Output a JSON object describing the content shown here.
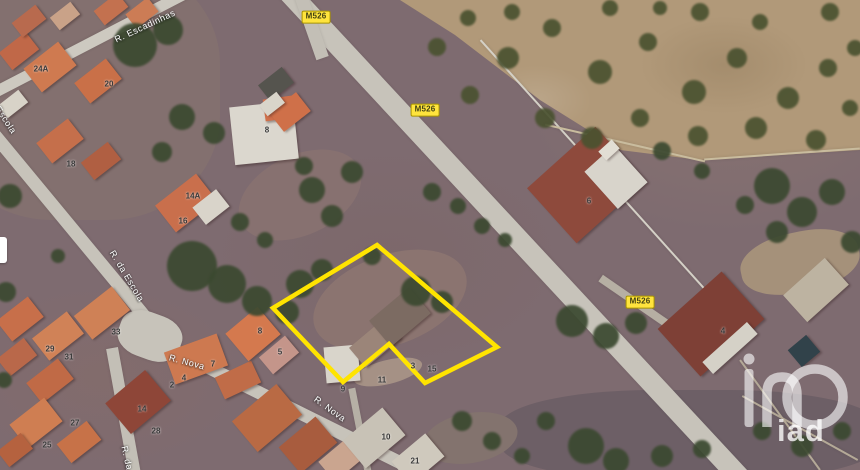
{
  "map": {
    "kind": "satellite-aerial-view",
    "watermark": {
      "text": "iad"
    },
    "parcel": {
      "outline_color": "#ffe400",
      "points": [
        [
          377,
          245
        ],
        [
          497,
          347
        ],
        [
          425,
          383
        ],
        [
          389,
          344
        ],
        [
          343,
          382
        ],
        [
          273,
          308
        ]
      ]
    },
    "road_badges": [
      {
        "label": "M526",
        "x": 316,
        "y": 17
      },
      {
        "label": "M526",
        "x": 425,
        "y": 110
      },
      {
        "label": "M526",
        "x": 640,
        "y": 302
      }
    ],
    "street_labels": [
      {
        "text": "R. Escadinhas",
        "x": 145,
        "y": 26,
        "angle": -25
      },
      {
        "text": "Escola",
        "x": 6,
        "y": 120,
        "angle": 57
      },
      {
        "text": "R. da Escola",
        "x": 127,
        "y": 276,
        "angle": 59
      },
      {
        "text": "R. Nova",
        "x": 187,
        "y": 362,
        "angle": 15
      },
      {
        "text": "R. Nova",
        "x": 330,
        "y": 409,
        "angle": 36
      },
      {
        "text": "R. da",
        "x": 127,
        "y": 458,
        "angle": 77
      }
    ],
    "house_numbers": [
      {
        "text": "24A",
        "x": 41,
        "y": 69
      },
      {
        "text": "20",
        "x": 109,
        "y": 84
      },
      {
        "text": "18",
        "x": 71,
        "y": 164
      },
      {
        "text": "8",
        "x": 267,
        "y": 130
      },
      {
        "text": "14A",
        "x": 193,
        "y": 196
      },
      {
        "text": "16",
        "x": 183,
        "y": 221
      },
      {
        "text": "6",
        "x": 589,
        "y": 201
      },
      {
        "text": "4",
        "x": 723,
        "y": 331
      },
      {
        "text": "33",
        "x": 116,
        "y": 332
      },
      {
        "text": "29",
        "x": 50,
        "y": 349
      },
      {
        "text": "31",
        "x": 69,
        "y": 357
      },
      {
        "text": "27",
        "x": 75,
        "y": 423
      },
      {
        "text": "25",
        "x": 47,
        "y": 445
      },
      {
        "text": "14",
        "x": 142,
        "y": 409
      },
      {
        "text": "28",
        "x": 156,
        "y": 431
      },
      {
        "text": "8",
        "x": 260,
        "y": 331
      },
      {
        "text": "5",
        "x": 280,
        "y": 352
      },
      {
        "text": "7",
        "x": 213,
        "y": 364
      },
      {
        "text": "4",
        "x": 184,
        "y": 378
      },
      {
        "text": "2",
        "x": 172,
        "y": 385
      },
      {
        "text": "3",
        "x": 413,
        "y": 366
      },
      {
        "text": "15",
        "x": 432,
        "y": 369
      },
      {
        "text": "11",
        "x": 382,
        "y": 380
      },
      {
        "text": "9",
        "x": 343,
        "y": 389
      },
      {
        "text": "10",
        "x": 386,
        "y": 437
      },
      {
        "text": "21",
        "x": 415,
        "y": 461
      }
    ],
    "features": {
      "roads": [
        [
          512,
          232,
          676,
          21,
          47.1,
          "#c7c3ba"
        ],
        [
          311,
          26,
          67,
          13,
          70.7,
          "#c3bfb6"
        ],
        [
          95,
          40,
          226,
          11,
          -27.4,
          "#cdc9c0"
        ],
        [
          69,
          225,
          241,
          13,
          50.4,
          "#c7c3ba"
        ],
        [
          285,
          405,
          328,
          13,
          26.4,
          "#c7c3ba"
        ],
        [
          124,
          414,
          134,
          12,
          79.7,
          "#c3bfb6"
        ],
        [
          360,
          430,
          86,
          7,
          79,
          "#b6b0a5"
        ],
        [
          645,
          309,
          109,
          8,
          34.6,
          "#b6afa3"
        ],
        [
          150,
          336,
          64,
          46,
          20,
          "#c7c3ba",
          40
        ],
        [
          611,
          185,
          390,
          2,
          48,
          "#d4d0c6"
        ],
        [
          625,
          143,
          164,
          2,
          13,
          "#c9bc9e"
        ],
        [
          782,
          154,
          156,
          2,
          -4,
          "#c9bc9e"
        ],
        [
          800,
          428,
          132,
          2,
          29,
          "#b4a997"
        ],
        [
          780,
          415,
          136,
          2,
          54,
          "#b4a997"
        ]
      ],
      "fields": [
        [
          80,
          90,
          280,
          260,
          0,
          "#83706f",
          40
        ],
        [
          690,
          435,
          380,
          90,
          0,
          "#6d5f66",
          40
        ],
        [
          800,
          262,
          120,
          60,
          -12,
          "#a5917a",
          45
        ],
        [
          390,
          300,
          160,
          90,
          -20,
          "#8b7470",
          50
        ],
        [
          300,
          195,
          130,
          80,
          -25,
          "#877170",
          50
        ],
        [
          470,
          438,
          95,
          50,
          -10,
          "#83736e",
          50
        ],
        [
          388,
          372,
          70,
          24,
          -14,
          "#a59185",
          50
        ]
      ],
      "buildings": [
        [
          19,
          51,
          34,
          22,
          -38,
          "#c06848"
        ],
        [
          50,
          67,
          44,
          30,
          -38,
          "#cf7a50"
        ],
        [
          98,
          81,
          40,
          26,
          -38,
          "#c97048"
        ],
        [
          29,
          21,
          30,
          18,
          -38,
          "#b86a4e"
        ],
        [
          65,
          16,
          26,
          16,
          -38,
          "#c9a288"
        ],
        [
          111,
          9,
          30,
          18,
          -38,
          "#c3714f"
        ],
        [
          142,
          13,
          28,
          18,
          -38,
          "#cc7c55"
        ],
        [
          13,
          104,
          26,
          16,
          -38,
          "#d8d3c8"
        ],
        [
          60,
          141,
          40,
          26,
          -38,
          "#c56f4b"
        ],
        [
          101,
          161,
          34,
          22,
          -38,
          "#b05f42"
        ],
        [
          264,
          133,
          64,
          58,
          -6,
          "#dbd7ce"
        ],
        [
          282,
          108,
          36,
          22,
          -8,
          "#cf6f4a"
        ],
        [
          276,
          84,
          30,
          20,
          -38,
          "#55544e"
        ],
        [
          290,
          112,
          34,
          24,
          -38,
          "#cf7049"
        ],
        [
          272,
          104,
          22,
          14,
          -38,
          "#d9d5ca"
        ],
        [
          186,
          203,
          52,
          34,
          -38,
          "#c96f4c"
        ],
        [
          211,
          207,
          30,
          22,
          -38,
          "#d9d4ca"
        ],
        [
          20,
          319,
          40,
          26,
          -38,
          "#c76f4a"
        ],
        [
          58,
          336,
          44,
          28,
          -38,
          "#d08257"
        ],
        [
          102,
          313,
          48,
          30,
          -38,
          "#cf8156"
        ],
        [
          17,
          357,
          34,
          22,
          -38,
          "#b9684a"
        ],
        [
          50,
          381,
          40,
          26,
          -38,
          "#c06a46"
        ],
        [
          36,
          423,
          44,
          30,
          -38,
          "#cf7e52"
        ],
        [
          79,
          442,
          38,
          24,
          -38,
          "#c77248"
        ],
        [
          15,
          450,
          30,
          20,
          -38,
          "#b5623f"
        ],
        [
          138,
          402,
          52,
          40,
          -40,
          "#8e4638"
        ],
        [
          196,
          359,
          56,
          34,
          -20,
          "#cd7950"
        ],
        [
          238,
          380,
          40,
          24,
          -25,
          "#c06c48"
        ],
        [
          253,
          334,
          42,
          36,
          -40,
          "#d4794e"
        ],
        [
          279,
          355,
          34,
          22,
          -40,
          "#c4958a"
        ],
        [
          267,
          418,
          58,
          40,
          -40,
          "#b96a44"
        ],
        [
          308,
          445,
          48,
          34,
          -40,
          "#a85c3e"
        ],
        [
          342,
          459,
          40,
          26,
          -40,
          "#caa58f"
        ],
        [
          374,
          438,
          52,
          36,
          -40,
          "#c8c2b6"
        ],
        [
          418,
          459,
          44,
          30,
          -40,
          "#cfc9bd"
        ],
        [
          342,
          364,
          34,
          36,
          -5,
          "#d9d5cb"
        ],
        [
          375,
          343,
          46,
          26,
          -40,
          "#9b8579"
        ],
        [
          400,
          317,
          52,
          34,
          -40,
          "#7c6b62"
        ],
        [
          586,
          185,
          92,
          74,
          -42,
          "#8e4a3c"
        ],
        [
          616,
          177,
          40,
          50,
          -42,
          "#d8d4cb"
        ],
        [
          609,
          150,
          18,
          12,
          -42,
          "#e2ded4"
        ],
        [
          711,
          324,
          86,
          64,
          -42,
          "#7e4036"
        ],
        [
          730,
          348,
          60,
          16,
          -42,
          "#d5d1c7"
        ],
        [
          816,
          290,
          56,
          36,
          -42,
          "#bdb3a1"
        ],
        [
          804,
          351,
          24,
          22,
          -40,
          "#31424a"
        ]
      ],
      "trees_olive": [
        [
          437,
          47,
          9
        ],
        [
          468,
          18,
          8
        ],
        [
          508,
          58,
          11
        ],
        [
          552,
          28,
          9
        ],
        [
          600,
          72,
          12
        ],
        [
          648,
          42,
          9
        ],
        [
          694,
          92,
          12
        ],
        [
          737,
          58,
          10
        ],
        [
          788,
          98,
          11
        ],
        [
          828,
          68,
          9
        ],
        [
          545,
          118,
          10
        ],
        [
          592,
          138,
          11
        ],
        [
          640,
          118,
          9
        ],
        [
          698,
          136,
          10
        ],
        [
          756,
          128,
          11
        ],
        [
          816,
          140,
          10
        ],
        [
          850,
          108,
          8
        ],
        [
          470,
          95,
          9
        ],
        [
          512,
          12,
          8
        ],
        [
          700,
          12,
          9
        ],
        [
          760,
          22,
          8
        ],
        [
          830,
          12,
          9
        ],
        [
          855,
          48,
          8
        ],
        [
          610,
          8,
          8
        ],
        [
          660,
          8,
          7
        ]
      ],
      "trees_dark": [
        [
          135,
          45,
          22
        ],
        [
          168,
          30,
          15
        ],
        [
          182,
          117,
          13
        ],
        [
          214,
          133,
          11
        ],
        [
          162,
          152,
          10
        ],
        [
          192,
          266,
          25
        ],
        [
          227,
          284,
          19
        ],
        [
          257,
          301,
          15
        ],
        [
          300,
          284,
          14
        ],
        [
          322,
          270,
          11
        ],
        [
          287,
          312,
          12
        ],
        [
          312,
          190,
          13
        ],
        [
          332,
          216,
          11
        ],
        [
          352,
          172,
          11
        ],
        [
          304,
          166,
          9
        ],
        [
          240,
          222,
          9
        ],
        [
          265,
          240,
          8
        ],
        [
          416,
          291,
          15
        ],
        [
          442,
          302,
          11
        ],
        [
          372,
          256,
          9
        ],
        [
          432,
          192,
          9
        ],
        [
          458,
          206,
          8
        ],
        [
          482,
          226,
          8
        ],
        [
          505,
          240,
          7
        ],
        [
          572,
          321,
          16
        ],
        [
          606,
          336,
          13
        ],
        [
          636,
          323,
          11
        ],
        [
          662,
          151,
          9
        ],
        [
          702,
          171,
          8
        ],
        [
          772,
          186,
          18
        ],
        [
          802,
          212,
          15
        ],
        [
          832,
          192,
          13
        ],
        [
          852,
          242,
          11
        ],
        [
          777,
          232,
          11
        ],
        [
          745,
          205,
          9
        ],
        [
          586,
          446,
          18
        ],
        [
          616,
          461,
          13
        ],
        [
          662,
          456,
          11
        ],
        [
          702,
          449,
          9
        ],
        [
          546,
          421,
          9
        ],
        [
          762,
          431,
          9
        ],
        [
          802,
          446,
          11
        ],
        [
          842,
          431,
          9
        ],
        [
          462,
          421,
          10
        ],
        [
          492,
          441,
          9
        ],
        [
          522,
          456,
          8
        ],
        [
          10,
          196,
          12
        ],
        [
          6,
          292,
          10
        ],
        [
          58,
          256,
          7
        ],
        [
          4,
          380,
          8
        ]
      ]
    }
  },
  "colors": {
    "parcel": "#ffe400",
    "badge-bg": "#ffe43d",
    "badge-border": "#a89300",
    "badge-text": "#403f12",
    "street-label": "#ffffff",
    "house-number": "#3a3a3a",
    "base": "#7e6b70",
    "field": "#b19979",
    "tree-dark": "#3b4930",
    "tree-olive": "#4a5230"
  }
}
